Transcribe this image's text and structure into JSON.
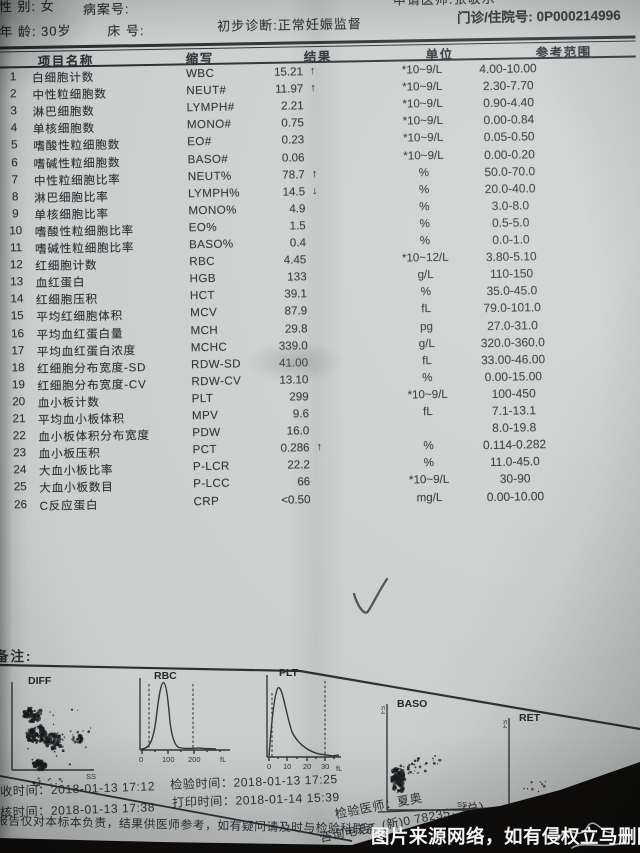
{
  "header": {
    "sex": "性 别: 女",
    "case_no": "病案号:",
    "requesting_doctor": "申请医师:张敬乐",
    "age": "年 龄: 30岁",
    "bed": "床 号:",
    "diagnosis": "初步诊断:正常妊娠监督",
    "visit_no": "门诊/住院号: 0P000214996"
  },
  "table": {
    "columns": [
      "项目名称",
      "缩写",
      "结果",
      "单位",
      "参考范围"
    ],
    "rows": [
      {
        "no": "1",
        "name": "白细胞计数",
        "abbr": "WBC",
        "result": "15.21",
        "flag": "↑",
        "unit": "*10~9/L",
        "ref": "4.00-10.00"
      },
      {
        "no": "2",
        "name": "中性粒细胞数",
        "abbr": "NEUT#",
        "result": "11.97",
        "flag": "↑",
        "unit": "*10~9/L",
        "ref": "2.30-7.70"
      },
      {
        "no": "3",
        "name": "淋巴细胞数",
        "abbr": "LYMPH#",
        "result": "2.21",
        "flag": "",
        "unit": "*10~9/L",
        "ref": "0.90-4.40"
      },
      {
        "no": "4",
        "name": "单核细胞数",
        "abbr": "MONO#",
        "result": "0.75",
        "flag": "",
        "unit": "*10~9/L",
        "ref": "0.00-0.84"
      },
      {
        "no": "5",
        "name": "嗜酸性粒细胞数",
        "abbr": "EO#",
        "result": "0.23",
        "flag": "",
        "unit": "*10~9/L",
        "ref": "0.05-0.50"
      },
      {
        "no": "6",
        "name": "嗜碱性粒细胞数",
        "abbr": "BASO#",
        "result": "0.06",
        "flag": "",
        "unit": "*10~9/L",
        "ref": "0.00-0.20"
      },
      {
        "no": "7",
        "name": "中性粒细胞比率",
        "abbr": "NEUT%",
        "result": "78.7",
        "flag": "↑",
        "unit": "%",
        "ref": "50.0-70.0"
      },
      {
        "no": "8",
        "name": "淋巴细胞比率",
        "abbr": "LYMPH%",
        "result": "14.5",
        "flag": "↓",
        "unit": "%",
        "ref": "20.0-40.0"
      },
      {
        "no": "9",
        "name": "单核细胞比率",
        "abbr": "MONO%",
        "result": "4.9",
        "flag": "",
        "unit": "%",
        "ref": "3.0-8.0"
      },
      {
        "no": "10",
        "name": "嗜酸性粒细胞比率",
        "abbr": "EO%",
        "result": "1.5",
        "flag": "",
        "unit": "%",
        "ref": "0.5-5.0"
      },
      {
        "no": "11",
        "name": "嗜碱性粒细胞比率",
        "abbr": "BASO%",
        "result": "0.4",
        "flag": "",
        "unit": "%",
        "ref": "0.0-1.0"
      },
      {
        "no": "12",
        "name": "红细胞计数",
        "abbr": "RBC",
        "result": "4.45",
        "flag": "",
        "unit": "*10~12/L",
        "ref": "3.80-5.10"
      },
      {
        "no": "13",
        "name": "血红蛋白",
        "abbr": "HGB",
        "result": "133",
        "flag": "",
        "unit": "g/L",
        "ref": "110-150"
      },
      {
        "no": "14",
        "name": "红细胞压积",
        "abbr": "HCT",
        "result": "39.1",
        "flag": "",
        "unit": "%",
        "ref": "35.0-45.0"
      },
      {
        "no": "15",
        "name": "平均红细胞体积",
        "abbr": "MCV",
        "result": "87.9",
        "flag": "",
        "unit": "fL",
        "ref": "79.0-101.0"
      },
      {
        "no": "16",
        "name": "平均血红蛋白量",
        "abbr": "MCH",
        "result": "29.8",
        "flag": "",
        "unit": "pg",
        "ref": "27.0-31.0"
      },
      {
        "no": "17",
        "name": "平均血红蛋白浓度",
        "abbr": "MCHC",
        "result": "339.0",
        "flag": "",
        "unit": "g/L",
        "ref": "320.0-360.0"
      },
      {
        "no": "18",
        "name": "红细胞分布宽度-SD",
        "abbr": "RDW-SD",
        "result": "41.00",
        "flag": "",
        "unit": "fL",
        "ref": "33.00-46.00"
      },
      {
        "no": "19",
        "name": "红细胞分布宽度-CV",
        "abbr": "RDW-CV",
        "result": "13.10",
        "flag": "",
        "unit": "%",
        "ref": "0.00-15.00"
      },
      {
        "no": "20",
        "name": "血小板计数",
        "abbr": "PLT",
        "result": "299",
        "flag": "",
        "unit": "*10~9/L",
        "ref": "100-450"
      },
      {
        "no": "21",
        "name": "平均血小板体积",
        "abbr": "MPV",
        "result": "9.6",
        "flag": "",
        "unit": "fL",
        "ref": "7.1-13.1"
      },
      {
        "no": "22",
        "name": "血小板体积分布宽度",
        "abbr": "PDW",
        "result": "16.0",
        "flag": "",
        "unit": "",
        "ref": "8.0-19.8"
      },
      {
        "no": "23",
        "name": "血小板压积",
        "abbr": "PCT",
        "result": "0.286",
        "flag": "↑",
        "unit": "%",
        "ref": "0.114-0.282"
      },
      {
        "no": "24",
        "name": "大血小板比率",
        "abbr": "P-LCR",
        "result": "22.2",
        "flag": "",
        "unit": "%",
        "ref": "11.0-45.0"
      },
      {
        "no": "25",
        "name": "大血小板数目",
        "abbr": "P-LCC",
        "result": "66",
        "flag": "",
        "unit": "*10~9/L",
        "ref": "30-90"
      },
      {
        "no": "26",
        "name": "C反应蛋白",
        "abbr": "CRP",
        "result": "<0.50",
        "flag": "",
        "unit": "mg/L",
        "ref": "0.00-10.00"
      }
    ]
  },
  "remark_label": "备注:",
  "handwriting": {
    "checkmark": "✓"
  },
  "charts": {
    "diff": {
      "title": "DIFF",
      "x_label": "SS"
    },
    "rbc": {
      "title": "RBC",
      "ticks": [
        "0",
        "100",
        "200"
      ],
      "x_unit": "fL"
    },
    "plt": {
      "title": "PLT",
      "ticks": [
        "0",
        "10",
        "20",
        "30"
      ],
      "x_unit": "fL"
    },
    "baso": {
      "title": "BASO",
      "x_label": "SS",
      "y_label": "FS"
    },
    "ret": {
      "title": "RET",
      "x_label": "SS",
      "y_label": "FS"
    }
  },
  "footer": {
    "collect_time": "收时间：2018-01-13  17:12",
    "test_time": "检验时间：2018-01-13  17:25",
    "review_time": "核时间：2018-01-13  17:38",
    "print_time": "打印时间：2018-01-14  15:39",
    "examiner": "检验医师：夏奥",
    "disclaimer": "报告仅对本标本负责，结果供医师参考，如有疑问请及时与检验科联系，",
    "phone_line1": "咨询电话：(新)0  78235，(总)",
    "phone_line2": "028-67695018"
  },
  "watermark": "图片来源网络，如有侵权立马删除"
}
